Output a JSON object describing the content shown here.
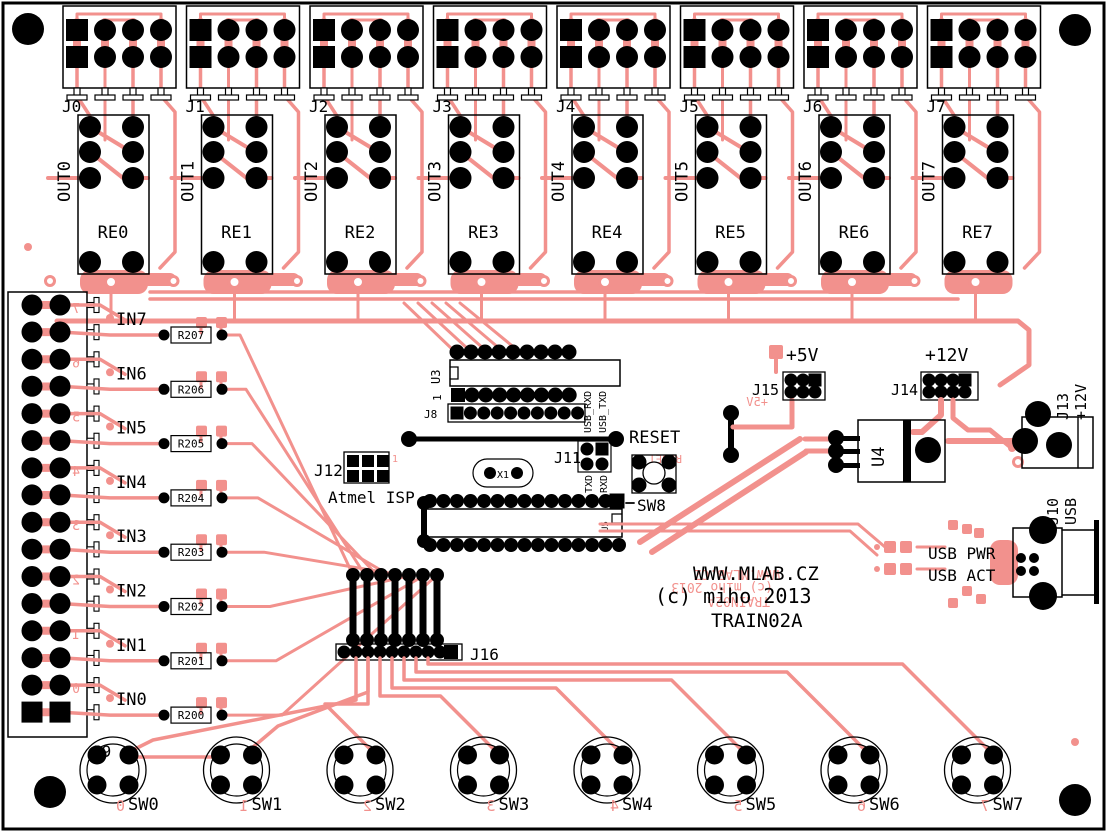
{
  "colors": {
    "copper": "#F2918D",
    "silk": "#000000",
    "pad": "#000000",
    "background": "#FFFFFF"
  },
  "title_block": {
    "url": "WWW.MLAB.CZ",
    "copyright": "(c) miho 2013",
    "board_name": "TRAIN02A"
  },
  "output_channels": [
    {
      "connector": "J0",
      "signal": "OUT0",
      "relay": "RE0"
    },
    {
      "connector": "J1",
      "signal": "OUT1",
      "relay": "RE1"
    },
    {
      "connector": "J2",
      "signal": "OUT2",
      "relay": "RE2"
    },
    {
      "connector": "J3",
      "signal": "OUT3",
      "relay": "RE3"
    },
    {
      "connector": "J4",
      "signal": "OUT4",
      "relay": "RE4"
    },
    {
      "connector": "J5",
      "signal": "OUT5",
      "relay": "RE5"
    },
    {
      "connector": "J6",
      "signal": "OUT6",
      "relay": "RE6"
    },
    {
      "connector": "J7",
      "signal": "OUT7",
      "relay": "RE7"
    }
  ],
  "input_block": {
    "connector": "J9",
    "channels": [
      {
        "signal": "IN7",
        "resistor": "R207",
        "digit": "7"
      },
      {
        "signal": "IN6",
        "resistor": "R206",
        "digit": "6"
      },
      {
        "signal": "IN5",
        "resistor": "R205",
        "digit": "5"
      },
      {
        "signal": "IN4",
        "resistor": "R204",
        "digit": "4"
      },
      {
        "signal": "IN3",
        "resistor": "R203",
        "digit": "3"
      },
      {
        "signal": "IN2",
        "resistor": "R202",
        "digit": "2"
      },
      {
        "signal": "IN1",
        "resistor": "R201",
        "digit": "1"
      },
      {
        "signal": "IN0",
        "resistor": "R200",
        "digit": "0"
      }
    ]
  },
  "switches": [
    {
      "ref": "SW0",
      "digit": "0"
    },
    {
      "ref": "SW1",
      "digit": "1"
    },
    {
      "ref": "SW2",
      "digit": "2"
    },
    {
      "ref": "SW3",
      "digit": "3"
    },
    {
      "ref": "SW4",
      "digit": "4"
    },
    {
      "ref": "SW5",
      "digit": "5"
    },
    {
      "ref": "SW6",
      "digit": "6"
    },
    {
      "ref": "SW7",
      "digit": "7"
    }
  ],
  "reset_button": {
    "label": "RESET",
    "ref": "SW8"
  },
  "ics": {
    "u3": "U3",
    "u4": "U4",
    "u5": "U5",
    "x1": "X1",
    "pin1": "1"
  },
  "headers": {
    "j8": "J8",
    "j11": "J11",
    "j11_top": [
      "USB_RXD",
      "USB_TXD"
    ],
    "j11_bottom": [
      "TXD",
      "RXD"
    ],
    "j12": "J12",
    "j12_desc": "Atmel ISP",
    "j16": "J16"
  },
  "power": {
    "rail_5v": "+5V",
    "j15": "J15",
    "rail_12v": "+12V",
    "j14": "J14",
    "j13": "J13",
    "j13_desc": "+12V"
  },
  "usb": {
    "j10": "J10",
    "j10_desc": "USB",
    "pwr_led": "USB PWR",
    "act_led": "USB ACT"
  }
}
